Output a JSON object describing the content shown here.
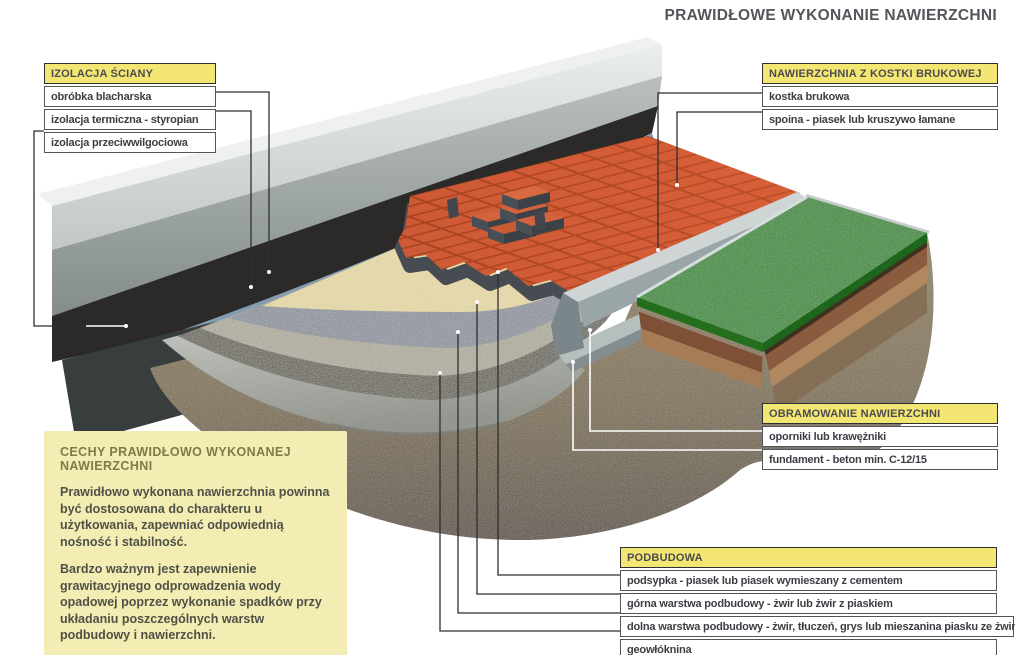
{
  "title": "PRAWIDŁOWE WYKONANIE NAWIERZCHNI",
  "callouts": {
    "izolacja_sciany": {
      "header": "IZOLACJA ŚCIANY",
      "rows": [
        "obróbka blacharska",
        "izolacja termiczna - styropian",
        "izolacja przeciwwilgociowa"
      ]
    },
    "nawierzchnia": {
      "header": "NAWIERZCHNIA Z KOSTKI BRUKOWEJ",
      "rows": [
        "kostka brukowa",
        "spoina - piasek lub kruszywo łamane"
      ]
    },
    "obramowanie": {
      "header": "OBRAMOWANIE NAWIERZCHNI",
      "rows": [
        "oporniki lub krawężniki",
        "fundament - beton min. C-12/15"
      ]
    },
    "podbudowa": {
      "header": "PODBUDOWA",
      "rows": [
        "podsypka - piasek lub piasek wymieszany z cementem",
        "górna warstwa podbudowy - żwir lub żwir z piaskiem",
        "dolna warstwa podbudowy - żwir, tłuczeń, grys lub mieszanina piasku ze żwirem",
        "geowłóknina"
      ]
    }
  },
  "info_box": {
    "header": "CECHY PRAWIDŁOWO WYKONANEJ NAWIERZCHNI",
    "paragraphs": [
      "Prawidłowo wykonana nawierzchnia powinna być dostosowana do charakteru u użytkowania, zapewniać odpowiednią nośność i stabilność.",
      "Bardzo ważnym jest zapewnienie grawitacyjnego odprowadzenia wody opadowej poprzez wykonanie spadków przy układaniu poszczególnych warstw podbudowy i nawierzchni."
    ]
  },
  "colors": {
    "callout_header_bg": "#f4e673",
    "info_box_bg": "#f3edb3",
    "paver_red": "#cd5936",
    "grass_green": "#2e8d25",
    "sand": "#ecdfa8",
    "gravel_blue_gray": "#8c929d",
    "soil_brown": "#83734f",
    "flashing_blue": "#7f9cb4",
    "title_text": "#54555a"
  }
}
